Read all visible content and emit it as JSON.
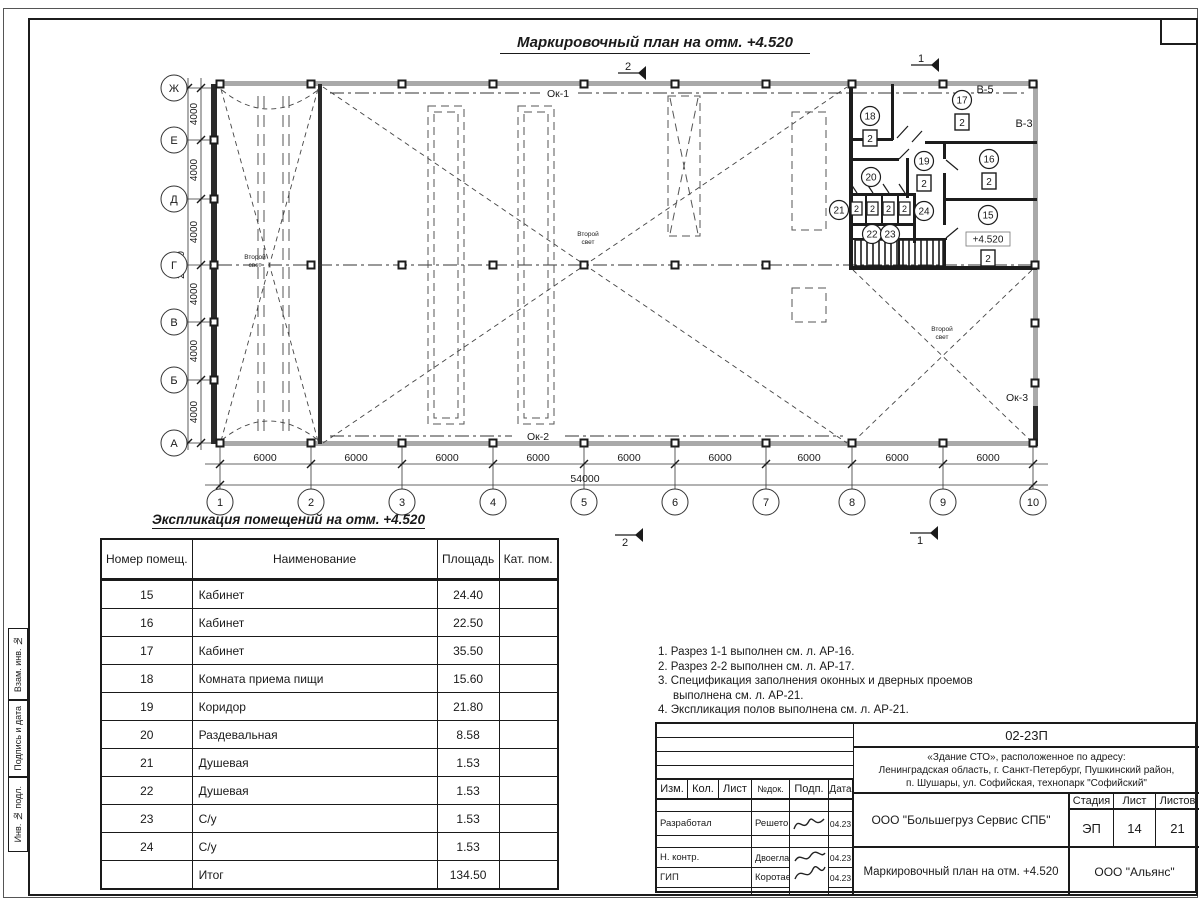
{
  "plan": {
    "title": "Маркировочный план на отм. +4.520",
    "axes_h": [
      "1",
      "2",
      "3",
      "4",
      "5",
      "6",
      "7",
      "8",
      "9",
      "10"
    ],
    "axes_v": [
      "Ж",
      "Е",
      "Д",
      "Г",
      "В",
      "Б",
      "А"
    ],
    "bay_h": "6000",
    "total_h": "54000",
    "bay_v": "4000",
    "total_v": "24000",
    "ok1": "Ок-1",
    "ok2": "Ок-2",
    "ok3": "Ок-3",
    "v5": "В-5",
    "v3": "В-3",
    "second_light_1": "Второй",
    "second_light_2": "свет",
    "level": "+4.520",
    "cat": "2",
    "sec_1": "1",
    "sec_2": "2",
    "rooms": {
      "r15": "15",
      "r16": "16",
      "r17": "17",
      "r18": "18",
      "r19": "19",
      "r20": "20",
      "r21": "21",
      "r22": "22",
      "r23": "23",
      "r24": "24"
    }
  },
  "table": {
    "title": "Экспликация помещений на отм. +4.520",
    "headers": {
      "num": "Номер помещ.",
      "name": "Наименование",
      "area": "Площадь",
      "cat": "Кат. пом."
    },
    "rows": [
      {
        "num": "15",
        "name": "Кабинет",
        "area": "24.40",
        "cat": ""
      },
      {
        "num": "16",
        "name": "Кабинет",
        "area": "22.50",
        "cat": ""
      },
      {
        "num": "17",
        "name": "Кабинет",
        "area": "35.50",
        "cat": ""
      },
      {
        "num": "18",
        "name": "Комната приема пищи",
        "area": "15.60",
        "cat": ""
      },
      {
        "num": "19",
        "name": "Коридор",
        "area": "21.80",
        "cat": ""
      },
      {
        "num": "20",
        "name": "Раздевальная",
        "area": "8.58",
        "cat": ""
      },
      {
        "num": "21",
        "name": "Душевая",
        "area": "1.53",
        "cat": ""
      },
      {
        "num": "22",
        "name": "Душевая",
        "area": "1.53",
        "cat": ""
      },
      {
        "num": "23",
        "name": "С/у",
        "area": "1.53",
        "cat": ""
      },
      {
        "num": "24",
        "name": "С/у",
        "area": "1.53",
        "cat": ""
      }
    ],
    "total_label": "Итог",
    "total_area": "134.50"
  },
  "notes": [
    "1. Разрез 1-1 выполнен см. л. АР-16.",
    "2. Разрез 2-2 выполнен см. л. АР-17.",
    "3. Спецификация заполнения оконных и дверных проемов выполнена см. л. АР-21.",
    "4. Экспликация полов выполнена см. л. АР-21."
  ],
  "titleblock": {
    "doc_number": "02-23П",
    "object_line1": "«Здание СТО», расположенное по адресу:",
    "object_line2": "Ленинградская область, г. Санкт-Петербург, Пушкинский район,",
    "object_line3": "п. Шушары, ул. Софийская, технопарк \"Софийский\"",
    "cols": {
      "izm": "Изм.",
      "kol": "Кол.",
      "list": "Лист",
      "ndoc": "№док.",
      "podp": "Подп.",
      "data": "Дата"
    },
    "roles": {
      "dev": "Разработал",
      "ncontr": "Н. контр.",
      "gip": "ГИП"
    },
    "names": {
      "dev": "Решетова",
      "ncontr": "Двоеглазов",
      "gip": "Коротаев"
    },
    "dates": {
      "dev": "04.23",
      "ncontr": "04.23",
      "gip": "04.23"
    },
    "company": "ООО \"Большегруз Сервис СПБ\"",
    "stage_label": "Стадия",
    "sheet_label": "Лист",
    "sheets_label": "Листов",
    "stage": "ЭП",
    "sheet": "14",
    "sheets": "21",
    "sheet_title": "Маркировочный план на отм. +4.520",
    "org": "ООО \"Альянс\""
  },
  "side_stamp": {
    "s1": "Взам. инв. №",
    "s2": "Подпись и дата",
    "s3": "Инв. № подл."
  }
}
